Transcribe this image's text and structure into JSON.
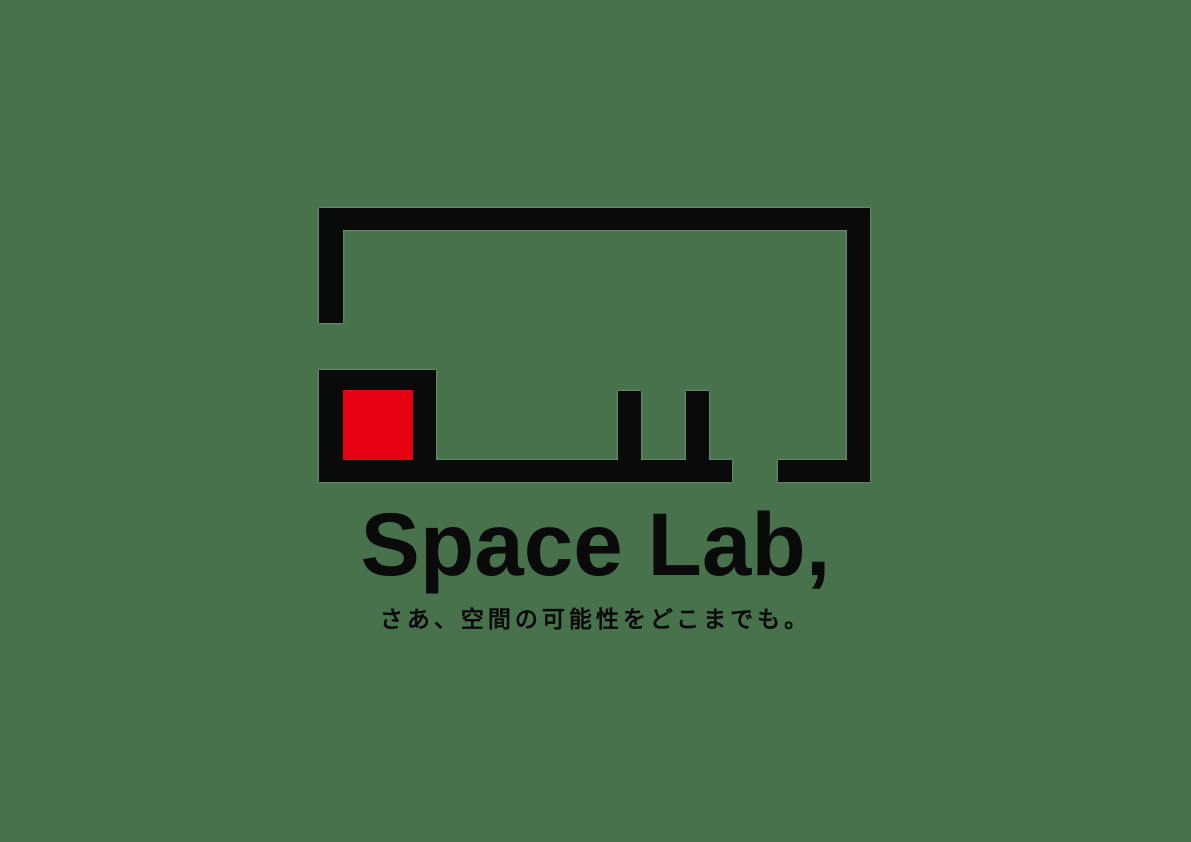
{
  "page": {
    "background_color": "#47724c"
  },
  "logo": {
    "wordmark": "Space Lab,",
    "tagline": "さあ、空間の可能性をどこまでも。",
    "mark": {
      "color": "#0a0a0a",
      "accent_color": "#e60012",
      "description": "abstract room floor-plan outline: open rectangle with door gap in bottom wall, framed corner square holding a red square, and two interior pillars",
      "elements": [
        "top-wall",
        "left-wall-upper",
        "right-wall",
        "bottom-wall-left",
        "bottom-wall-right",
        "corner-square-frame",
        "red-square",
        "pillar-1",
        "pillar-2"
      ]
    }
  }
}
